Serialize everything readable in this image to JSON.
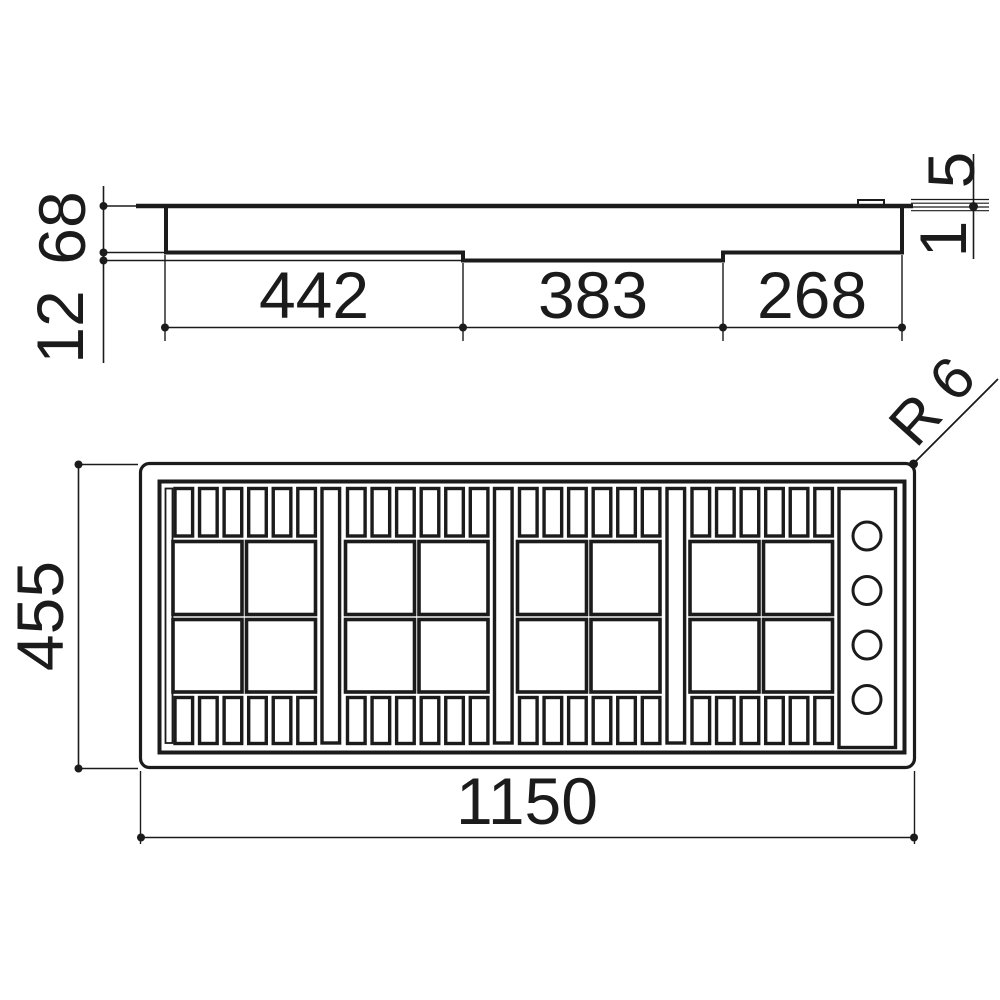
{
  "document": {
    "background": "#ffffff",
    "line_color": "#1b1b1b"
  },
  "side_view": {
    "depth_main": "68",
    "depth_step": "12",
    "section_left": "442",
    "section_middle": "383",
    "section_right": "268",
    "rim_height": "5",
    "rim_lip": "1"
  },
  "plan_view": {
    "overall_width": "1150",
    "overall_depth": "455",
    "corner_radius": "R 6",
    "knob_count": 4,
    "grate_group_count": 4
  }
}
